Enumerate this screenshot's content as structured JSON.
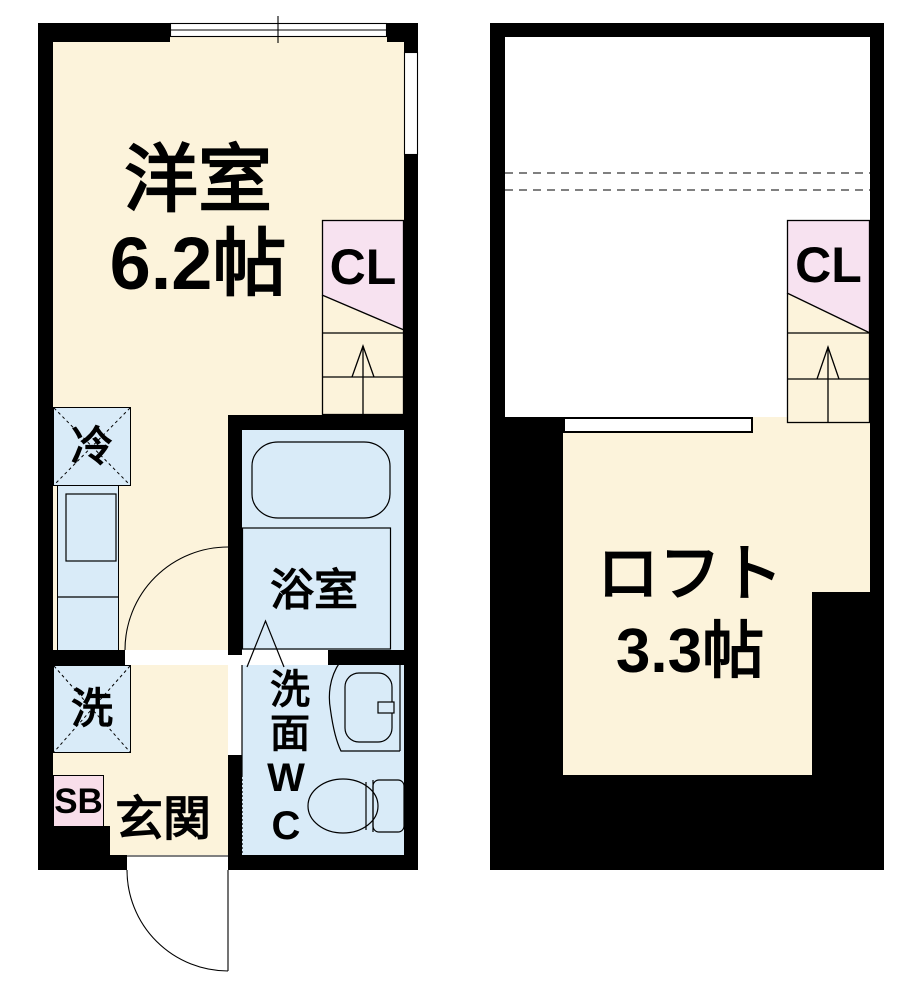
{
  "plan": {
    "type": "apartment-floorplan",
    "first_floor": {
      "main_room": {
        "name": "洋室",
        "size": "6.2帖"
      },
      "closet": "CL",
      "refrigerator": "冷",
      "bathroom": "浴室",
      "washroom": "洗面WC",
      "washer": "洗",
      "shoe_box": "SB",
      "entrance": "玄関"
    },
    "loft": {
      "room": {
        "name": "ロフト",
        "size": "3.3帖"
      },
      "closet": "CL"
    }
  },
  "colors": {
    "wall_black": "#000000",
    "floor_cream": "#FCF3DB",
    "wet_area_blue": "#D9EBF8",
    "closet_pink": "#F7E2F0",
    "shoebox_pink": "#F8DEEA",
    "background": "#ffffff"
  }
}
